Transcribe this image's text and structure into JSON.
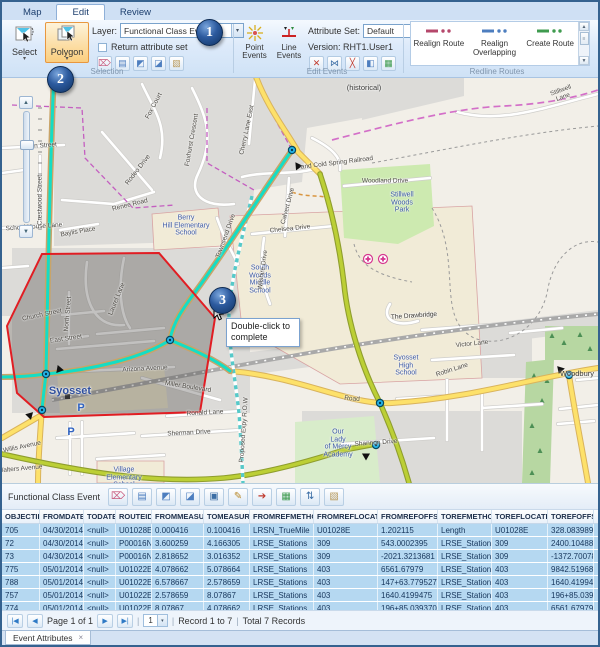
{
  "tabs": {
    "map": "Map",
    "edit": "Edit",
    "review": "Review"
  },
  "ribbon": {
    "selection": {
      "select_label": "Select",
      "polygon_label": "Polygon",
      "layer_label": "Layer:",
      "layer_value": "Functional Class Event",
      "return_attribute_set": "Return attribute set",
      "group_label": "Selection",
      "icons": [
        {
          "name": "clear-selection-icon",
          "glyph": "⌦",
          "color": "#c85a7c"
        },
        {
          "name": "selection-list-icon",
          "glyph": "▤",
          "color": "#4d7ebf"
        },
        {
          "name": "select-by-location-icon",
          "glyph": "◩",
          "color": "#4d7ebf"
        },
        {
          "name": "select-by-attributes-icon",
          "glyph": "◪",
          "color": "#4d7ebf"
        },
        {
          "name": "selection-options-icon",
          "glyph": "▧",
          "color": "#b9995a"
        }
      ]
    },
    "edit_events": {
      "point_events_label": "Point Events",
      "line_events_label": "Line Events",
      "attribute_set_label": "Attribute Set:",
      "attribute_set_value": "Default",
      "version_label": "Version: RHT1.User1",
      "group_label": "Edit Events",
      "icons": [
        {
          "name": "split-event-icon",
          "glyph": "✕",
          "color": "#c0392b"
        },
        {
          "name": "merge-events-icon",
          "glyph": "⋈",
          "color": "#3c6ea5"
        },
        {
          "name": "snap-event-icon",
          "glyph": "╳",
          "color": "#c0392b"
        },
        {
          "name": "event-editor-icon",
          "glyph": "◧",
          "color": "#4d7ebf"
        },
        {
          "name": "event-table-icon",
          "glyph": "▦",
          "color": "#3f9b4f"
        }
      ]
    },
    "redline": {
      "realign_route": "Realign Route",
      "realign_overlapping": "Realign Overlapping",
      "create_route": "Create Route",
      "group_label": "Redline Routes",
      "realign_route_color": "#b5476b",
      "realign_overlapping_color": "#4d7ebf",
      "create_route_color": "#3f9b4f"
    },
    "dropdown_arrow": "▾"
  },
  "callouts": {
    "one": "1",
    "two": "2",
    "three": "3"
  },
  "map": {
    "tooltip": "Double-click to complete",
    "labels": [
      {
        "t": "Syosset",
        "x": 68,
        "y": 313,
        "c": "city"
      },
      {
        "t": "Berry\nHill Elementary\nSchool",
        "x": 184,
        "y": 148,
        "c": "poi"
      },
      {
        "t": "South\nWoods\nMiddle\nSchool",
        "x": 258,
        "y": 202,
        "c": "poi"
      },
      {
        "t": "Syosset\nHigh\nSchool",
        "x": 404,
        "y": 288,
        "c": "poi"
      },
      {
        "t": "Stillwell\nWoods\nPark",
        "x": 400,
        "y": 125,
        "c": "poi"
      },
      {
        "t": "Our\nLady\nof Mercy\nAcademy",
        "x": 336,
        "y": 366,
        "c": "poi"
      },
      {
        "t": "Village\nElementary\nSchool",
        "x": 122,
        "y": 400,
        "c": "poi"
      },
      {
        "t": "Woodbury",
        "x": 575,
        "y": 296,
        "c": "place"
      },
      {
        "t": "(historical)",
        "x": 362,
        "y": 10,
        "c": "place"
      },
      {
        "t": "and Cold Spring Railroad",
        "x": 335,
        "y": 85,
        "r": -7,
        "c": "street"
      },
      {
        "t": "Woodland Drive",
        "x": 383,
        "y": 103,
        "c": "street"
      },
      {
        "t": "Stillwell Lane",
        "x": 560,
        "y": 16,
        "r": -20,
        "c": "street"
      },
      {
        "t": "Fox Court",
        "x": 152,
        "y": 28,
        "r": -62,
        "c": "street"
      },
      {
        "t": "Foxhurst Crescent",
        "x": 190,
        "y": 62,
        "r": -80,
        "c": "street"
      },
      {
        "t": "Cherry Lane East",
        "x": 245,
        "y": 52,
        "r": -78,
        "c": "street"
      },
      {
        "t": "Rodeo Drive",
        "x": 136,
        "y": 92,
        "r": -52,
        "c": "street"
      },
      {
        "t": "Renee Road",
        "x": 128,
        "y": 127,
        "r": -14,
        "c": "street"
      },
      {
        "t": "Ayen Street",
        "x": 38,
        "y": 68,
        "r": -4,
        "c": "street"
      },
      {
        "t": "Crestwood Street",
        "x": 38,
        "y": 122,
        "r": -90,
        "c": "street"
      },
      {
        "t": "School House Lane",
        "x": 32,
        "y": 149,
        "r": -4,
        "c": "street"
      },
      {
        "t": "Baylis Place",
        "x": 76,
        "y": 154,
        "r": -10,
        "c": "street"
      },
      {
        "t": "Church Street",
        "x": 40,
        "y": 237,
        "r": -12,
        "c": "street"
      },
      {
        "t": "North Street",
        "x": 66,
        "y": 236,
        "r": -85,
        "c": "street"
      },
      {
        "t": "East Street",
        "x": 64,
        "y": 261,
        "r": -8,
        "c": "street"
      },
      {
        "t": "Laurel Lane",
        "x": 115,
        "y": 221,
        "r": -68,
        "c": "street"
      },
      {
        "t": "Arizona Avenue",
        "x": 143,
        "y": 291,
        "r": -3,
        "c": "street"
      },
      {
        "t": "Miller Boulevard",
        "x": 186,
        "y": 309,
        "r": 9,
        "c": "street"
      },
      {
        "t": "Ronald Lane",
        "x": 203,
        "y": 335,
        "r": -3,
        "c": "street"
      },
      {
        "t": "Sherman Drive",
        "x": 187,
        "y": 355,
        "r": -3,
        "c": "street"
      },
      {
        "t": "Willis Avenue",
        "x": 20,
        "y": 369,
        "r": -12,
        "c": "street"
      },
      {
        "t": "Walters Avenue",
        "x": 18,
        "y": 391,
        "r": -5,
        "c": "street"
      },
      {
        "t": "Chelsea Drive",
        "x": 288,
        "y": 151,
        "r": -6,
        "c": "street"
      },
      {
        "t": "Calvert Drive",
        "x": 286,
        "y": 128,
        "r": -75,
        "c": "street"
      },
      {
        "t": "Townsend Drive",
        "x": 224,
        "y": 158,
        "r": -70,
        "c": "street"
      },
      {
        "t": "Wilshire Drive",
        "x": 261,
        "y": 192,
        "r": -82,
        "c": "street"
      },
      {
        "t": "The Drawbridge",
        "x": 412,
        "y": 238,
        "r": -4,
        "c": "street"
      },
      {
        "t": "Victor Lane",
        "x": 470,
        "y": 266,
        "r": -6,
        "c": "street"
      },
      {
        "t": "Robin Lane",
        "x": 450,
        "y": 292,
        "r": -18,
        "c": "street"
      },
      {
        "t": "Shannon Drive",
        "x": 374,
        "y": 365,
        "r": -4,
        "c": "street"
      },
      {
        "t": "Proposed Expy R.O.W",
        "x": 242,
        "y": 352,
        "r": -86,
        "c": "street"
      },
      {
        "t": "Road",
        "x": 350,
        "y": 321,
        "r": 5,
        "c": "street"
      },
      {
        "t": "The Drawbridge",
        "x": 412,
        "y": 238,
        "r": -4,
        "c": "street"
      },
      {
        "t": "P",
        "x": 79,
        "y": 330,
        "c": "parking"
      },
      {
        "t": "P",
        "x": 69,
        "y": 354,
        "c": "parking"
      }
    ]
  },
  "table": {
    "title": "Functional Class Event",
    "toolbar_icons": [
      {
        "name": "clear-selection-icon",
        "glyph": "⌦",
        "color": "#c85a7c"
      },
      {
        "name": "show-list-icon",
        "glyph": "▤",
        "color": "#4d7ebf"
      },
      {
        "name": "zoom-to-selection-icon",
        "glyph": "◩",
        "color": "#4d7ebf"
      },
      {
        "name": "pan-to-selection-icon",
        "glyph": "◪",
        "color": "#4d7ebf"
      },
      {
        "name": "save-icon",
        "glyph": "▣",
        "color": "#3c6ea5"
      },
      {
        "name": "edit-records-icon",
        "glyph": "✎",
        "color": "#b9892a"
      },
      {
        "name": "export-icon",
        "glyph": "➔",
        "color": "#c0392b"
      },
      {
        "name": "attribute-table-icon",
        "glyph": "▦",
        "color": "#3f9b4f"
      },
      {
        "name": "sort-icon",
        "glyph": "⇅",
        "color": "#3c6ea5"
      },
      {
        "name": "options-icon",
        "glyph": "▧",
        "color": "#b9995a"
      }
    ],
    "columns": [
      "OBJECTID",
      "FROMDATE",
      "TODATE",
      "ROUTEID",
      "FROMMEASURE",
      "TOMEASURE",
      "FROMREFMETHOD",
      "FROMREFLOCATION",
      "FROMREFOFFSET",
      "TOREFMETHOD",
      "TOREFLOCATION",
      "TOREFOFFSET"
    ],
    "rows": [
      [
        "705",
        "04/30/2014",
        "<null>",
        "U01028E",
        "0.000416",
        "0.100416",
        "LRSN_TrueMile",
        "U01028E",
        "1.202115",
        "Length",
        "U01028E",
        "328.0839895"
      ],
      [
        "72",
        "04/30/2014",
        "<null>",
        "P00016N",
        "3.600259",
        "4.166305",
        "LRSE_Stations",
        "309",
        "543.0002395",
        "LRSE_Stations",
        "309",
        "2400.1048819"
      ],
      [
        "73",
        "04/30/2014",
        "<null>",
        "P00016N",
        "2.818652",
        "3.016352",
        "LRSE_Stations",
        "309",
        "-2021.3213681",
        "LRSE_Stations",
        "309",
        "-1372.7007874"
      ],
      [
        "775",
        "05/01/2014",
        "<null>",
        "U01022E",
        "4.078662",
        "5.078664",
        "LRSE_Stations",
        "403",
        "6561.67979",
        "LRSE_Stations",
        "403",
        "9842.519685"
      ],
      [
        "788",
        "05/01/2014",
        "<null>",
        "U01022E",
        "6.578667",
        "2.578659",
        "LRSE_Stations",
        "403",
        "147+63.7795276",
        "LRSE_Stations",
        "403",
        "1640.4199475"
      ],
      [
        "757",
        "05/01/2014",
        "<null>",
        "U01022E",
        "2.578659",
        "8.07867",
        "LRSE_Stations",
        "403",
        "1640.4199475",
        "LRSE_Stations",
        "403",
        "196+85.0393701"
      ],
      [
        "774",
        "05/01/2014",
        "<null>",
        "U01022E",
        "8.07867",
        "4.078662",
        "LRSE_Stations",
        "403",
        "196+85.0393701",
        "LRSE_Stations",
        "403",
        "6561.67979"
      ]
    ]
  },
  "pagination": {
    "first_icon": "|◀",
    "prev_icon": "◀",
    "next_icon": "▶",
    "last_icon": "▶|",
    "page_label": "Page 1 of 1",
    "page_value": "1",
    "dropdown_arrow": "▾",
    "sep": "|",
    "record_label": "Record 1 to 7",
    "total_label": "Total 7 Records"
  },
  "bottom_tab": {
    "label": "Event Attributes",
    "close": "×"
  }
}
